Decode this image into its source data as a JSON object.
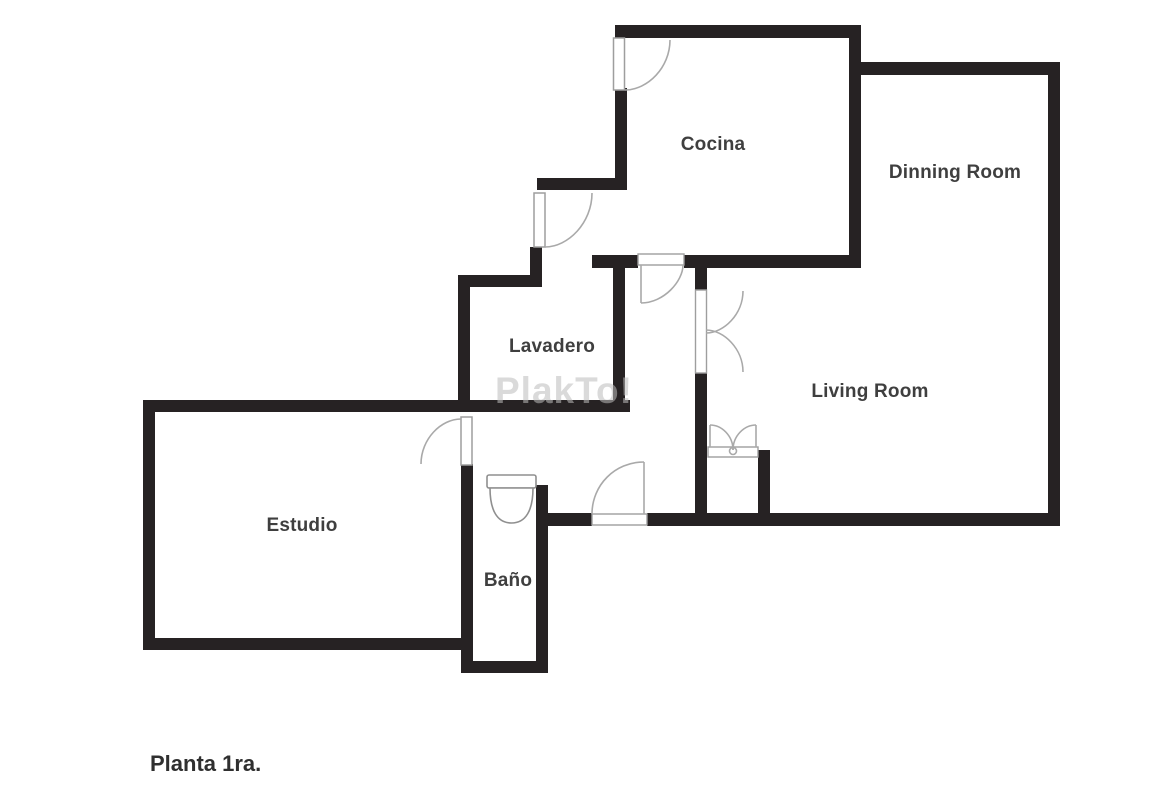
{
  "plan": {
    "title": "Planta 1ra.",
    "watermark_text": "PlakTo!",
    "room_labels": {
      "cocina": "Cocina",
      "dinning_room": "Dinning Room",
      "lavadero": "Lavadero",
      "living_room": "Living Room",
      "estudio": "Estudio",
      "bano": "Baño"
    },
    "colors": {
      "wall": "#262223",
      "door_outline": "#a9a9a9",
      "label_text": "#3f3f3f",
      "watermark": "#bdbdbd",
      "background": "#ffffff"
    },
    "fixtures": [
      "toilet"
    ],
    "doors": [
      "cocina-entry-door",
      "vestibule-door",
      "cocina-hall-door",
      "main-entrance-door",
      "estudio-door",
      "living-room-double-door",
      "closet-double-door"
    ]
  }
}
